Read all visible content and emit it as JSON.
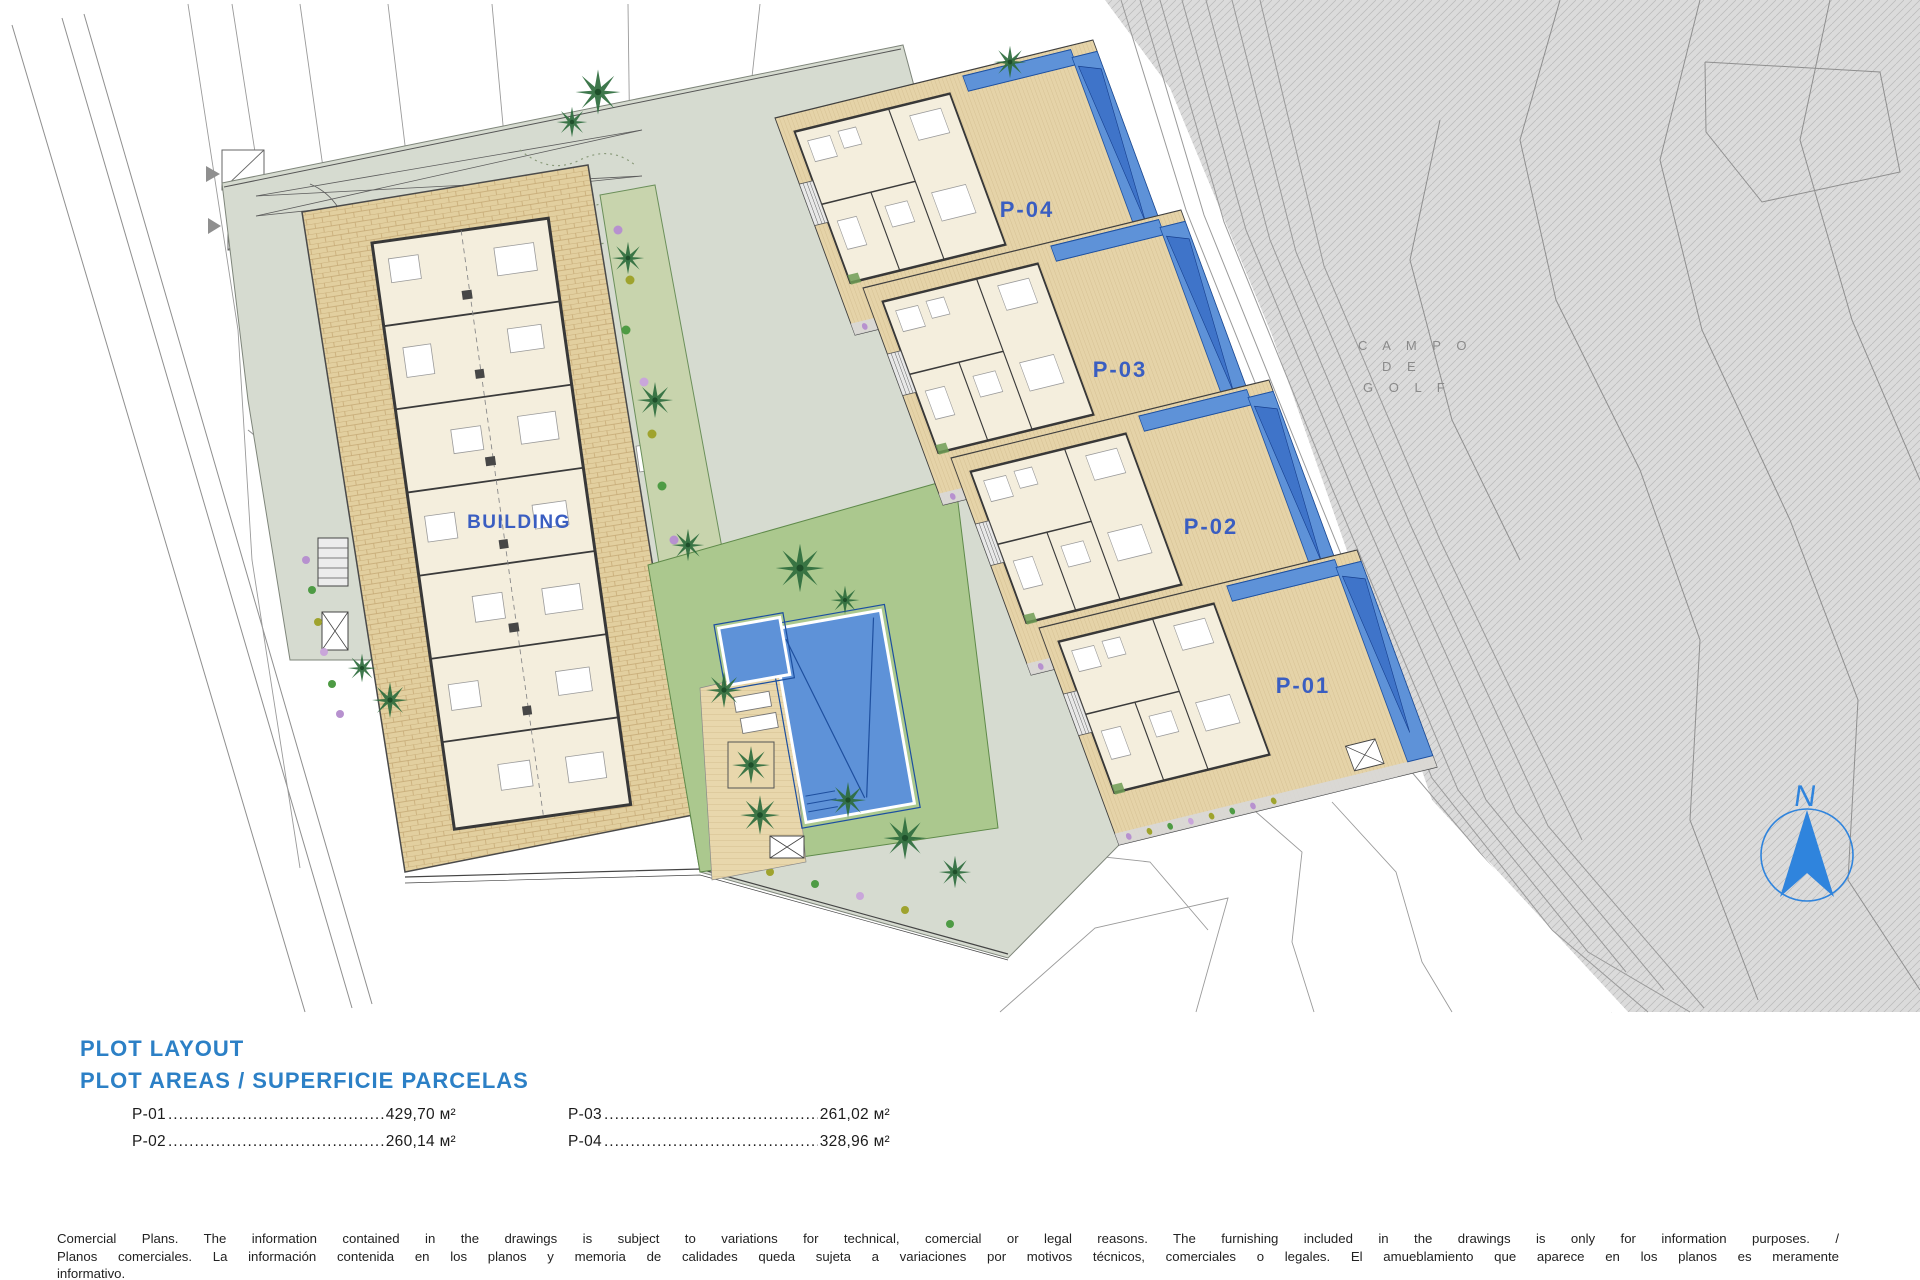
{
  "plan": {
    "building_label": "BUILDING",
    "plot_labels": [
      "P-04",
      "P-03",
      "P-02",
      "P-01"
    ],
    "golf_label": {
      "line1": "C A M P O",
      "line2": "D E",
      "line3": "G O L F"
    },
    "north_label": "N"
  },
  "info": {
    "title_line1": "PLOT LAYOUT",
    "title_line2": "PLOT AREAS / SUPERFICIE PARCELAS",
    "areas_col1": [
      {
        "label": "P-01",
        "value": "429,70 м²"
      },
      {
        "label": "P-02",
        "value": "260,14 м²"
      }
    ],
    "areas_col2": [
      {
        "label": "P-03",
        "value": "261,02 м²"
      },
      {
        "label": "P-04",
        "value": "328,96 м²"
      }
    ]
  },
  "disclaimer": {
    "line1": "Comercial Plans. The information contained in the drawings is subject to variations for technical, comercial or legal reasons. The furnishing included in the drawings is only for information purposes. /",
    "line2": "Planos comerciales. La información contenida en los planos y memoria de calidades queda sujeta a variaciones por motivos técnicos, comerciales o legales. El amueblamiento que aparece en los planos es meramente",
    "line3": "informativo."
  },
  "colors": {
    "heading_blue": "#2c80c6",
    "label_blue": "#3a5ec1",
    "pool_blue": "#5e92d8",
    "terrace_beige": "#e5d3a8",
    "lawn_green": "#abc88e",
    "walkway_sage": "#d6dbd0",
    "golf_gray": "#dbdbdb",
    "north_blue": "#2f84dd"
  }
}
